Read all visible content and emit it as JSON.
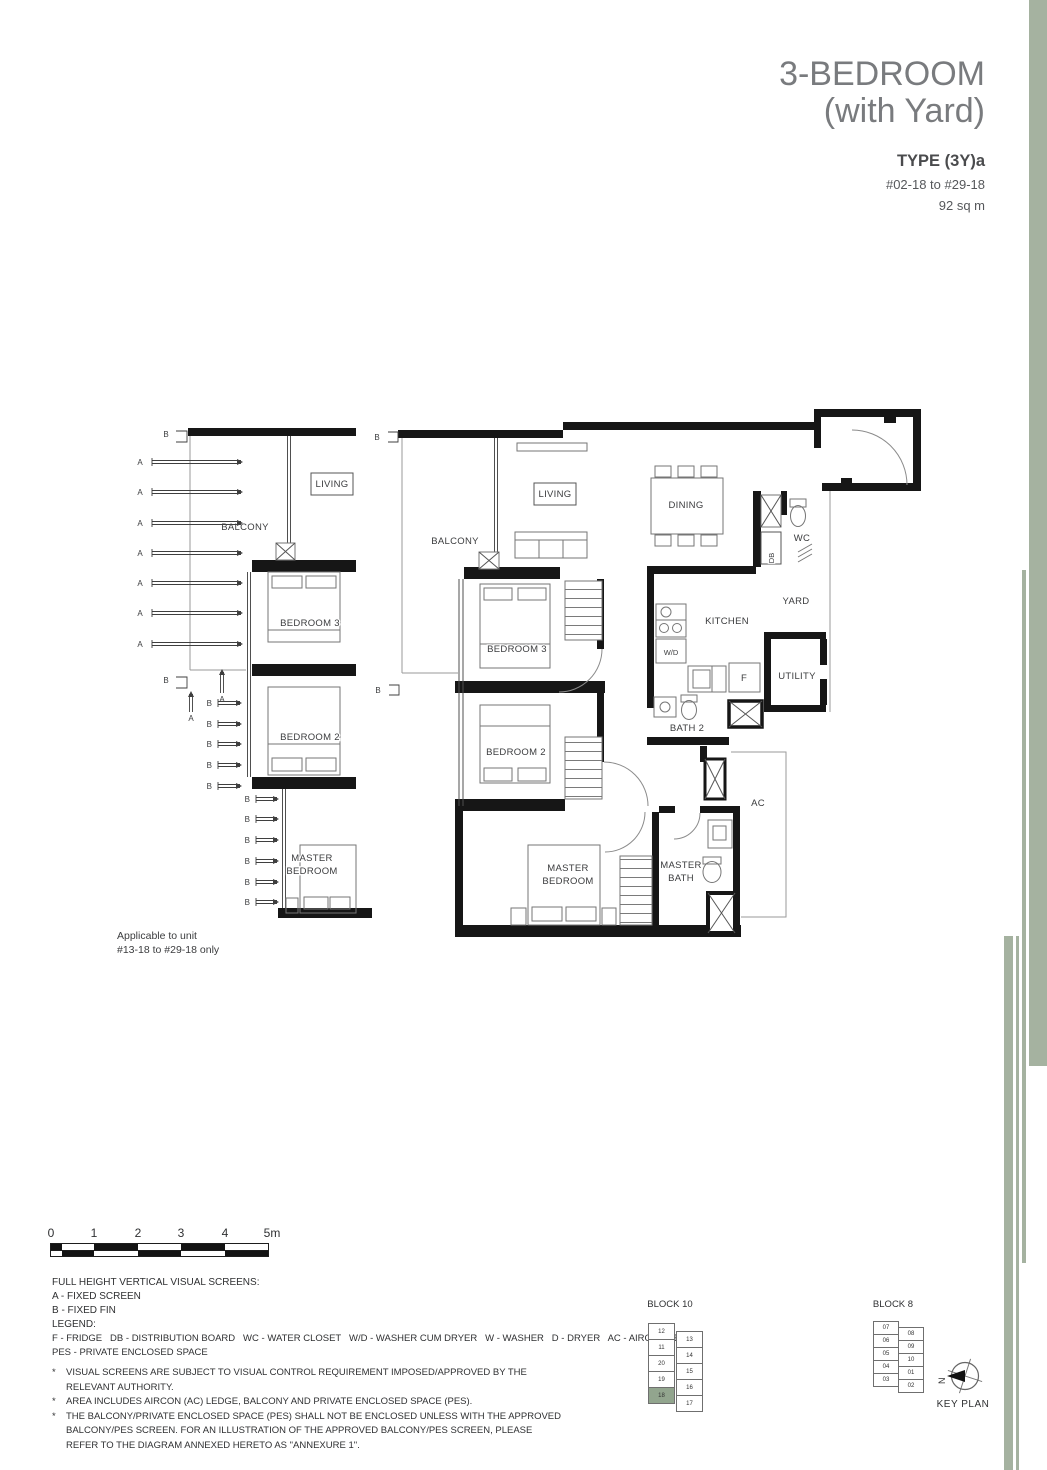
{
  "header": {
    "title_line1": "3-BEDROOM",
    "title_line2": "(with Yard)",
    "type": "TYPE (3Y)a",
    "units": "#02-18 to #29-18",
    "area": "92 sq m"
  },
  "colors": {
    "accent_bar": "#a5b2a0",
    "keyplan_highlight": "#92a58e",
    "wall": "#161616",
    "header_gray": "#797b7e"
  },
  "rooms": {
    "balcony": "BALCONY",
    "living": "LIVING",
    "dining": "DINING",
    "wc": "WC",
    "db": "DB",
    "yard": "YARD",
    "kitchen": "KITCHEN",
    "wd": "W/D",
    "fridge": "F",
    "utility": "UTILITY",
    "bedroom3": "BEDROOM 3",
    "bedroom2": "BEDROOM 2",
    "bath2": "BATH 2",
    "ac": "AC",
    "master_l1": "MASTER",
    "master_l2": "BEDROOM",
    "mbath_l1": "MASTER",
    "mbath_l2": "BATH"
  },
  "screens": {
    "a": "A",
    "b": "B"
  },
  "left_plan": {
    "note_line1": "Applicable to unit",
    "note_line2": "#13-18 to #29-18 only"
  },
  "scale_bar": {
    "ticks": [
      "0",
      "1",
      "2",
      "3",
      "4",
      "5m"
    ]
  },
  "visual_screens": {
    "title": "FULL HEIGHT VERTICAL VISUAL SCREENS:",
    "a": "A - FIXED SCREEN",
    "b": "B - FIXED FIN"
  },
  "legend": {
    "title": "LEGEND:",
    "line1": "F - FRIDGE   DB - DISTRIBUTION BOARD   WC - WATER CLOSET   W/D - WASHER CUM DRYER   W - WASHER   D - DRYER   AC - AIRCON LEDGE",
    "line2": "PES - PRIVATE ENCLOSED SPACE"
  },
  "notes": [
    {
      "bullet": "*",
      "text": "VISUAL SCREENS ARE SUBJECT TO VISUAL CONTROL REQUIREMENT IMPOSED/APPROVED BY THE RELEVANT AUTHORITY."
    },
    {
      "bullet": "*",
      "text": "AREA INCLUDES AIRCON (AC) LEDGE, BALCONY AND PRIVATE ENCLOSED SPACE (PES)."
    },
    {
      "bullet": "*",
      "text": "THE BALCONY/PRIVATE ENCLOSED SPACE (PES) SHALL NOT BE ENCLOSED UNLESS WITH THE APPROVED BALCONY/PES SCREEN. FOR AN ILLUSTRATION OF THE APPROVED BALCONY/PES SCREEN, PLEASE REFER TO THE DIAGRAM ANNEXED HERETO AS \"ANNEXURE 1\"."
    }
  ],
  "keyplan": {
    "block10": {
      "label": "BLOCK 10",
      "left": [
        "12",
        "11",
        "20",
        "19",
        "18"
      ],
      "right": [
        "13",
        "14",
        "15",
        "16",
        "17"
      ],
      "highlight": "18"
    },
    "block8": {
      "label": "BLOCK 8",
      "left": [
        "07",
        "06",
        "05",
        "04",
        "03"
      ],
      "right": [
        "08",
        "09",
        "10",
        "01",
        "02"
      ]
    },
    "compass_n": "N",
    "caption": "KEY PLAN"
  }
}
